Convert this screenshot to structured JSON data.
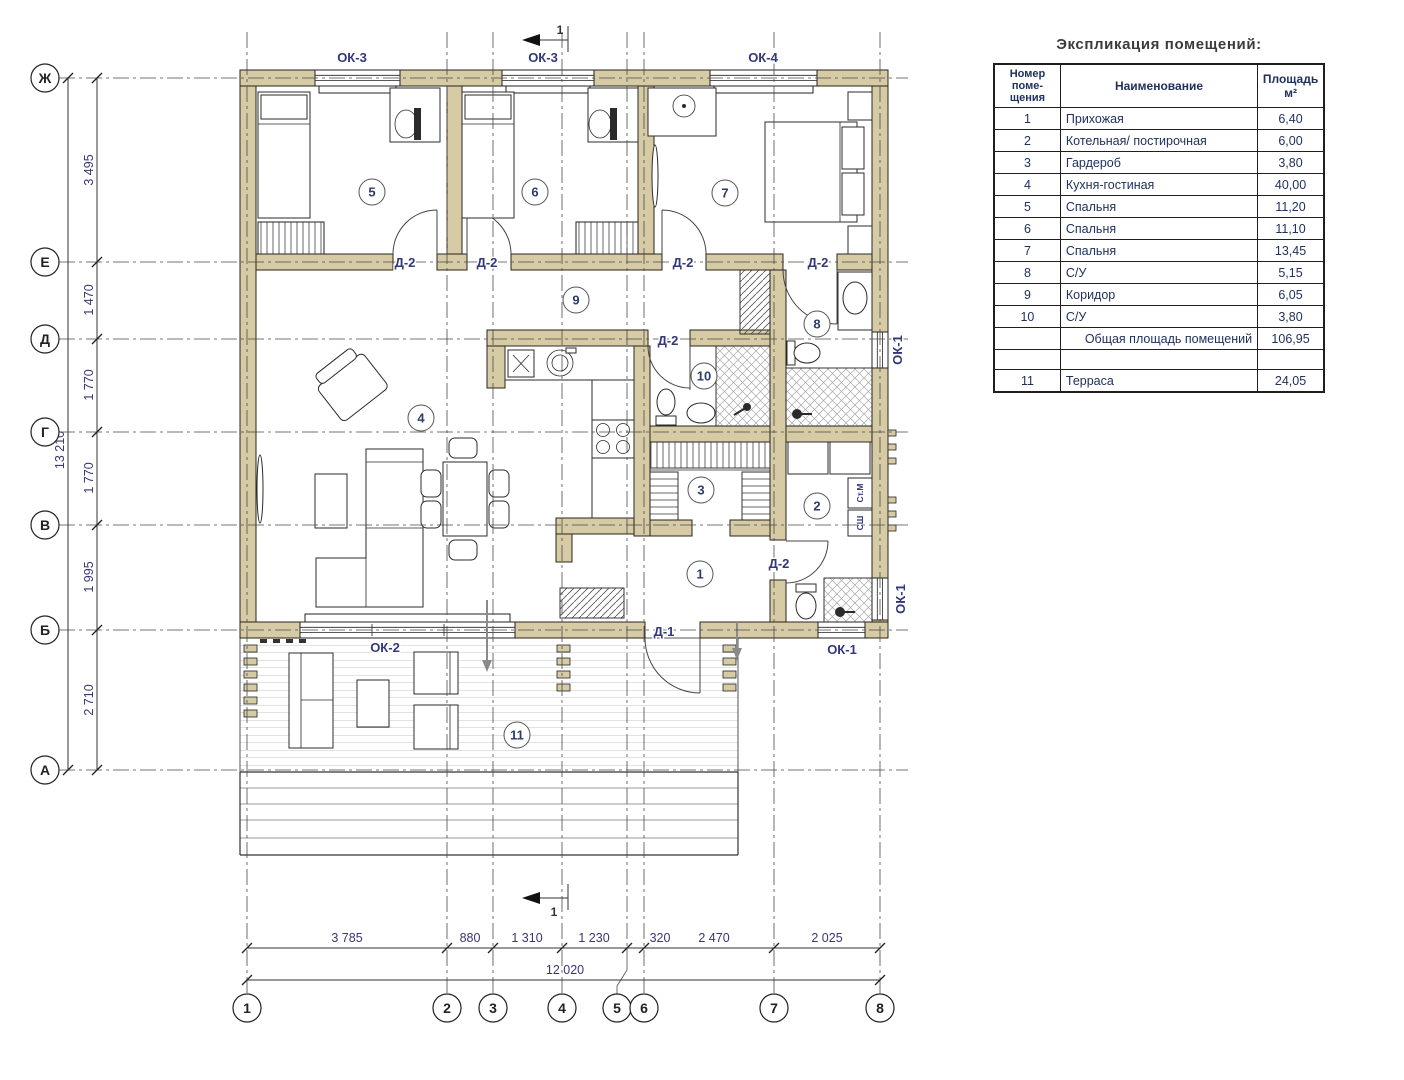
{
  "title": "Экспликация помещений:",
  "table": {
    "header": {
      "num": "Номер\nпоме-\nщения",
      "name": "Наименование",
      "area": "Площадь\nм²"
    },
    "rows": [
      {
        "num": "1",
        "name": "Прихожая",
        "area": "6,40"
      },
      {
        "num": "2",
        "name": "Котельная/ постирочная",
        "area": "6,00"
      },
      {
        "num": "3",
        "name": "Гардероб",
        "area": "3,80"
      },
      {
        "num": "4",
        "name": "Кухня-гостиная",
        "area": "40,00"
      },
      {
        "num": "5",
        "name": "Спальня",
        "area": "11,20"
      },
      {
        "num": "6",
        "name": "Спальня",
        "area": "11,10"
      },
      {
        "num": "7",
        "name": "Спальня",
        "area": "13,45"
      },
      {
        "num": "8",
        "name": "С/У",
        "area": "5,15"
      },
      {
        "num": "9",
        "name": "Коридор",
        "area": "6,05"
      },
      {
        "num": "10",
        "name": "С/У",
        "area": "3,80"
      }
    ],
    "total": {
      "num": "",
      "name": "Общая площадь помещений",
      "area": "106,95"
    },
    "empty": {
      "num": "",
      "name": "",
      "area": ""
    },
    "terrace": {
      "num": "11",
      "name": "Терраса",
      "area": "24,05"
    }
  },
  "axes": {
    "rows": [
      "Ж",
      "Е",
      "Д",
      "Г",
      "В",
      "Б",
      "А"
    ],
    "cols": [
      "1",
      "2",
      "3",
      "4",
      "5",
      "6",
      "7",
      "8"
    ]
  },
  "dims": {
    "left": [
      "3 495",
      "1 470",
      "1 770",
      "1 770",
      "1 995",
      "2 710"
    ],
    "left_total": "13 210",
    "bottom": [
      "3 785",
      "880",
      "1 310",
      "1 230",
      "320",
      "2 470",
      "2 025"
    ],
    "bottom_total": "12 020"
  },
  "rooms": [
    "1",
    "2",
    "3",
    "4",
    "5",
    "6",
    "7",
    "8",
    "9",
    "10",
    "11"
  ],
  "labels": {
    "ok3": "ОК-3",
    "ok4": "ОК-4",
    "ok2": "ОК-2",
    "ok1": "ОК-1",
    "d2": "Д-2",
    "d1": "Д-1",
    "section": "1",
    "washer": "Ст.М",
    "dryer": "СШ"
  },
  "colors": {
    "wall": "#d6cba4",
    "accent_text": "#33387a",
    "table_text": "#20315c"
  }
}
